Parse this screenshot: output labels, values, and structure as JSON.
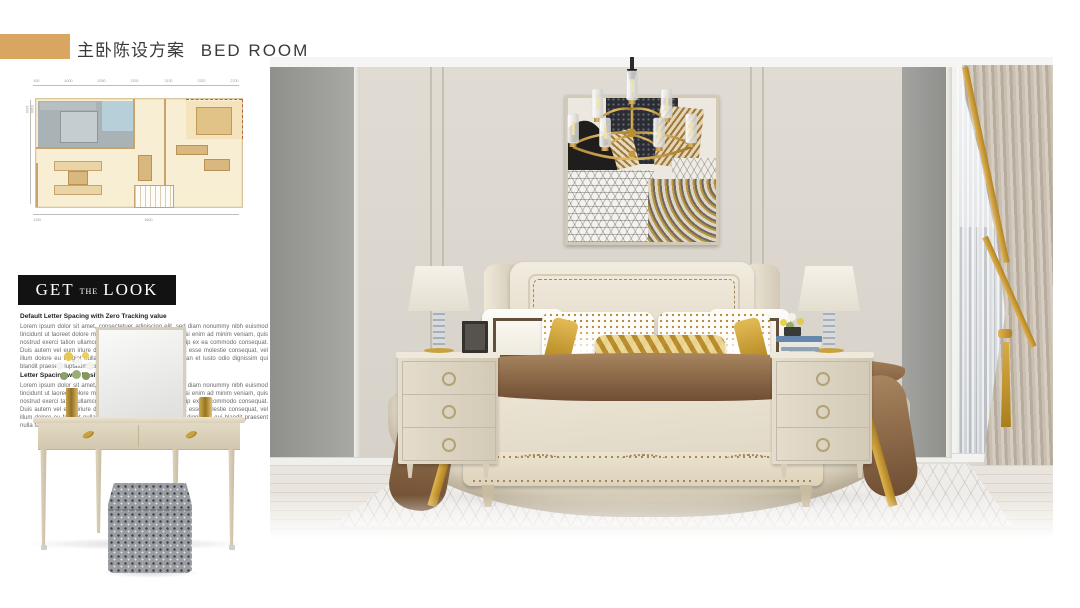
{
  "header": {
    "accent_color": "#d9a661",
    "title_cn": "主卧陈设方案",
    "title_en": "BED ROOM"
  },
  "floor_plan": {
    "top_dims": [
      "100",
      "4000",
      "2050",
      "2150",
      "2130",
      "2320",
      "2700"
    ],
    "left_dims": [
      "1700",
      "5100",
      "1200"
    ],
    "bottom_dims": [
      "1100",
      "4600"
    ],
    "colors": {
      "room": "#f8eed4",
      "wall": "#c9a36b",
      "highlight": "#a9b2b5",
      "bath": "#b7cfd9"
    }
  },
  "get_the_look": {
    "title_parts": [
      "GET",
      "THE",
      "LOOK"
    ],
    "banner_bg": "#121212",
    "heading1": "Default Letter Spacing with Zero Tracking value",
    "para1": "Lorem ipsum dolor sit amet, consectetuer adipiscing elit, sed diam nonummy nibh euismod tincidunt ut laoreet dolore magna aliquam erat volutpat. Ut wisi enim ad minim veniam, quis nostrud exerci tation ullamcorper suscipit lobortis nisl ut aliquip ex ea commodo consequat. Duis autem vel eum iriure dolor in hendrerit in vulputate velit esse molestie consequat, vel illum dolore eu feugiat nulla facilisis at vero eros et accumsan et iusto odio dignissim qui blandit praesent luptatum zzril delenit.",
    "heading2": "Letter Spacing with Positive Tracking value",
    "para2": "Lorem ipsum dolor sit amet, consectetuer adipiscing elit, sed diam nonummy nibh euismod tincidunt ut laoreet dolore magna aliquam erat volutpat. Ut wisi enim ad minim veniam, quis nostrud exerci tation ullamcorper suscipit lobortis nisl ut aliquip ex ea commodo consequat. Duis autem vel eum iriure dolor in hendrerit in vulputate velit esse molestie consequat, vel illum dolore eu feugiat nulla facilisis. accumsan et iusto odio dignissim qui blandit praesent nulla facilisi."
  },
  "scene": {
    "items": [
      "chandelier",
      "abstract-artwork",
      "upholstered-bed",
      "nightstand-left",
      "nightstand-right",
      "table-lamp-left",
      "table-lamp-right",
      "photo-frame",
      "flower-pot",
      "books",
      "window-sheer",
      "curtain-drape",
      "area-rug",
      "vanity-table",
      "vanity-mirror",
      "ottoman"
    ],
    "palette": {
      "wall_gray": "#999a96",
      "wall_cream": "#dcd7cf",
      "gold": "#c9a23f",
      "bedding": "#e3dccf",
      "throw_brown": "#7a5a3d",
      "floor": "#e9e5de"
    }
  }
}
